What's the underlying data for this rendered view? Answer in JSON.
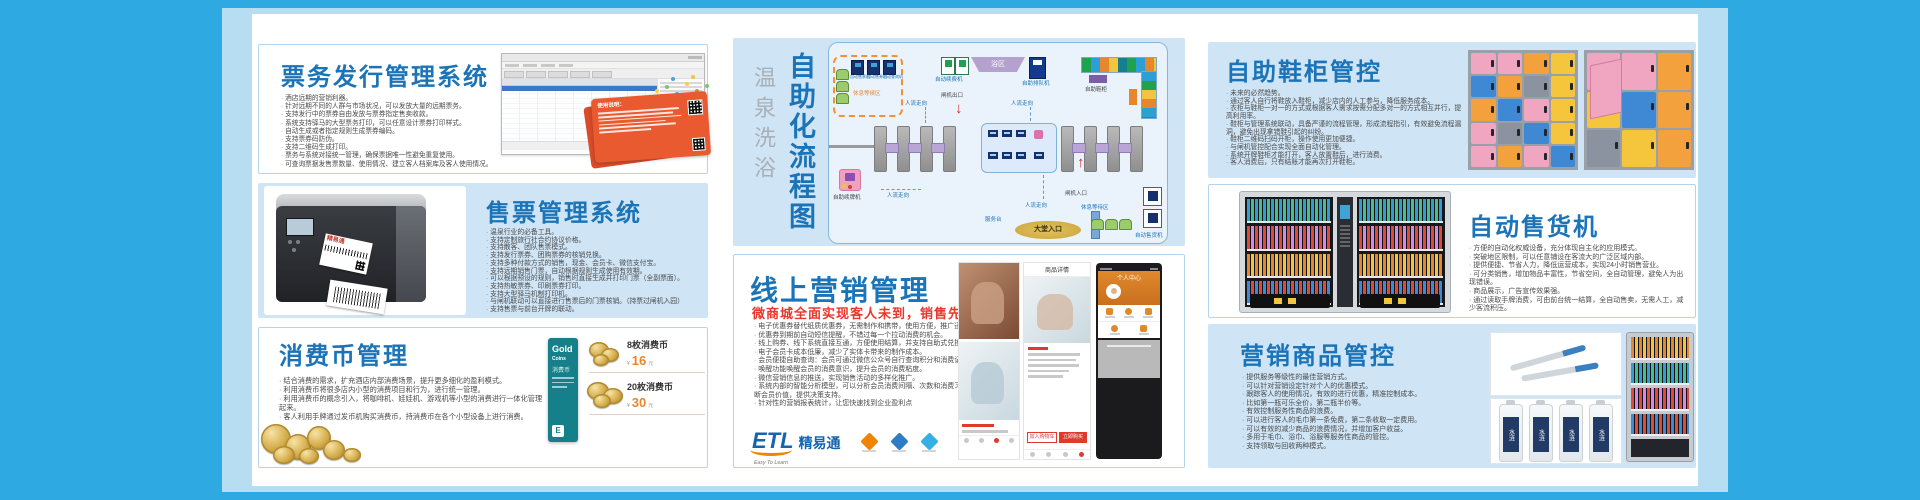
{
  "page": {
    "accent": "#1b74b8",
    "frame_blue": "#2fa9e2",
    "subtitle_red": "#e8372c"
  },
  "cards": {
    "ticket_issue": {
      "title": "票务发行管理系统",
      "bullets": [
        "酒店远期的营销利器。",
        "针对远期不同的人群与市场状况，可以发放大量的远期票务。",
        "支持发行中的票券自由发放与票券指定售卖收款。",
        "系统支持驿马的大型票务打印，可以任意设计票券打印样式。",
        "自动生成或者指定规则生成票券编码。",
        "支持票券码防伪。",
        "支持二维码生成打印。",
        "票务与系统对接统一管理，确保票据唯一性避免重复使用。",
        "可查询票据发售票数量、使用情况、建立客人档案库及客人使用情况。"
      ],
      "promo_title": "使用说明："
    },
    "ticket_sales": {
      "title": "售票管理系统",
      "printer_label": "精易通",
      "bullets": [
        "温泉行业的必备工具。",
        "支持定制旅行社合约协议价格。",
        "支持散客、团队售票模式。",
        "支持发行票券、团购票券的核销兑换。",
        "支持多种付款方式的销售，现金、会员卡、微信支付宝。",
        "支持远期销售门票，自动根据规则生成使用有效期。",
        "可以根据预设的规则，销售时直接生成并打印门票（全副票面）。",
        "支持热敏票券、印刷票券打印。",
        "支持大型驿马机制打印机。",
        "与闸机联动可以直接进行售票后的门票核销。（持票过闸机入园）",
        "支持售票与前台开牌的联动。"
      ]
    },
    "coins": {
      "title": "消费币管理",
      "bullets": [
        "结合消费的需求，扩充酒店内部消费场景，提升更多细化的盈利模式。",
        "利用消费币将很多店内小型的消费项目和行为，进行统一管理。",
        "利用消费币的概念引入，将咖啡机、娃娃机、游戏机等小型的消费进行一体化管理起来。",
        "客人利用手牌通过发币机购买消费币，持消费币在各个小型设备上进行消费。"
      ],
      "gold_card": {
        "word1": "Gold",
        "word2": "Coins",
        "cn": "消费币"
      },
      "prices": [
        {
          "name": "8枚消费币",
          "currency": "¥",
          "price": "16",
          "unit": "元"
        },
        {
          "name": "20枚消费币",
          "currency": "¥",
          "price": "30",
          "unit": "元"
        }
      ]
    },
    "flow": {
      "title_sub": "温泉洗浴",
      "title_main": "自助化流程图",
      "labels": {
        "waiting_top": "休息等候区",
        "machines_top": [
          "自动售票机",
          "自动售券机",
          "自动查询机"
        ],
        "renew": "自动续费机",
        "bath": "浴区",
        "queue": "自助排队机",
        "shoe": "自助鞋柜",
        "exit": "闸机出口",
        "entry": "闸机入口",
        "flow_dir": "人流走向",
        "card_renew": "自助续牌机",
        "desk": "服务台",
        "lobby": "大堂入口",
        "waiting_bottom": "休息等待区",
        "vending": "自动售货机"
      }
    },
    "online": {
      "title": "线上营销管理",
      "subtitle": "微商城全面实现客人未到，销售先行的理念",
      "bullets": [
        "电子优惠券替代纸质优惠券，无需制作和携带，使用方便，推广迅速",
        "优惠券到期前自动短信提醒，不错过每一个拉动消费的机会。",
        "线上购券、线下系统直接互通，方便使用结算，并支持自助式兑换。",
        "电子会员卡成本低廉，减少了实体卡带来的制作成本。",
        "会员便捷自助查询：会员可通过微信公众号自行查询积分和消费记录。",
        "唤醒功能唤醒会员的消费意识，提升会员的消费粘度。",
        "微信营销信息的推送，实现销售活动的多样化推广。",
        "系统内部的智能分析模型，可以分析会员消费间隔、次数和消费习惯，帮您精准判断会员价值，提供决策支持。",
        "针对性的营销报表统计，让您快速找到企业盈利点"
      ],
      "logo": {
        "name": "ETL",
        "cn": "精易通",
        "tagline": "Easy To Learn"
      },
      "phone": {
        "detail_title": "商品详情",
        "profile_title": "个人中心",
        "btn_cart": "加入购物车",
        "btn_buy": "立即购买"
      }
    },
    "shoe": {
      "title": "自助鞋柜管控",
      "bullets": [
        "未来的必然趋势。",
        "通过客人自行将鞋放入鞋柜，减少店内的人工参与，降低服务成本。",
        "衣柜与鞋柜一对一的方式或根据客人需求按需分配多对一的方式相互并行，提高利用率。",
        "鞋柜与管理系统联动，具备严谨的流程管理，形成流程指引，有效避免流程漏洞，避免出现拿错鞋引起的纠纷。",
        "鞋柜二维码扫码开柜，操作使用更加便捷。",
        "与闸机管控配合实现全面自动化管理。",
        "系统开牌鞋柜才能打开，客人放置鞋后，进行消费。",
        "客人消费后，只有结账才能再次打开鞋柜。"
      ]
    },
    "vending": {
      "title": "自动售货机",
      "bullets": [
        "方便的自动化权威设备，充分体现自主化的应用模式。",
        "突破地区限制，可以任意铺设在客流大的广泛区域内部。",
        "提供便捷、节省人力，降低运营成本，实现24小时销售营业。",
        "可分类销售，增加物品丰富性，节省空间，全自动管理，避免人为出现错误。",
        "商品展示，广告宣传效果强。",
        "通过读取手牌消费，可由前台统一结算，全自动售卖，无需人工，减少客流积压。"
      ]
    },
    "merch": {
      "title": "营销商品管控",
      "bottle_label": "水涟",
      "bullets": [
        "提供服务等级性的最佳营销方式。",
        "可以针对营销设定针对个人的优惠模式。",
        "跟踪客人的使用情况，有效的进行优惠，精准控制成本。",
        "比如第一瓶可乐全价，第二瓶半价等。",
        "有效控制服务性商品的浪费。",
        "可以进行客人的毛巾第一条免费，第二条收取一定费用。",
        "可以有效的减少商品的浪费情况，并增加客户收益。",
        "多用于毛巾、浴巾、浴服等服务性商品的管控。",
        "支持领取与回收两种模式。"
      ]
    }
  }
}
